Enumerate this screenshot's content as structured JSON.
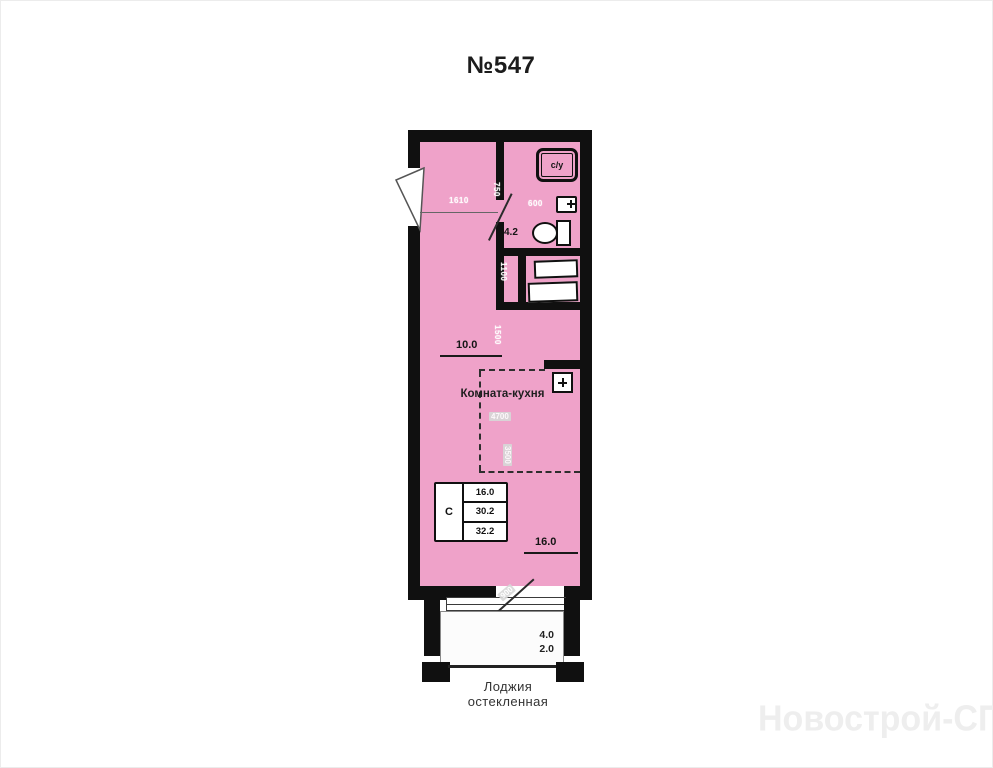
{
  "title": "№547",
  "watermark": "Новострой-СПб",
  "plan": {
    "room": {
      "label": "Комната-кухня",
      "width_dim": "10.0",
      "length_dim": "16.0",
      "kitchen_width_mm": "4700",
      "kitchen_depth_mm": "3500",
      "wall_dim_mm": "1500"
    },
    "hall": {
      "width_mm": "1610",
      "door_dim_mm": "750",
      "closet_dim_mm": "1100"
    },
    "bathroom": {
      "label": "с/у",
      "area": "4.2",
      "sink_dim_mm": "600"
    },
    "loggia": {
      "label_line1": "Лоджия",
      "label_line2": "остекленная",
      "area_full": "4.0",
      "area_coeff": "2.0",
      "door_dim_mm": "900"
    },
    "stats": {
      "type": "С",
      "living": "16.0",
      "area": "30.2",
      "total": "32.2"
    },
    "colors": {
      "interior": "#efa2c9",
      "wall": "#101010",
      "loggia_fill": "#fcfcfc"
    }
  }
}
